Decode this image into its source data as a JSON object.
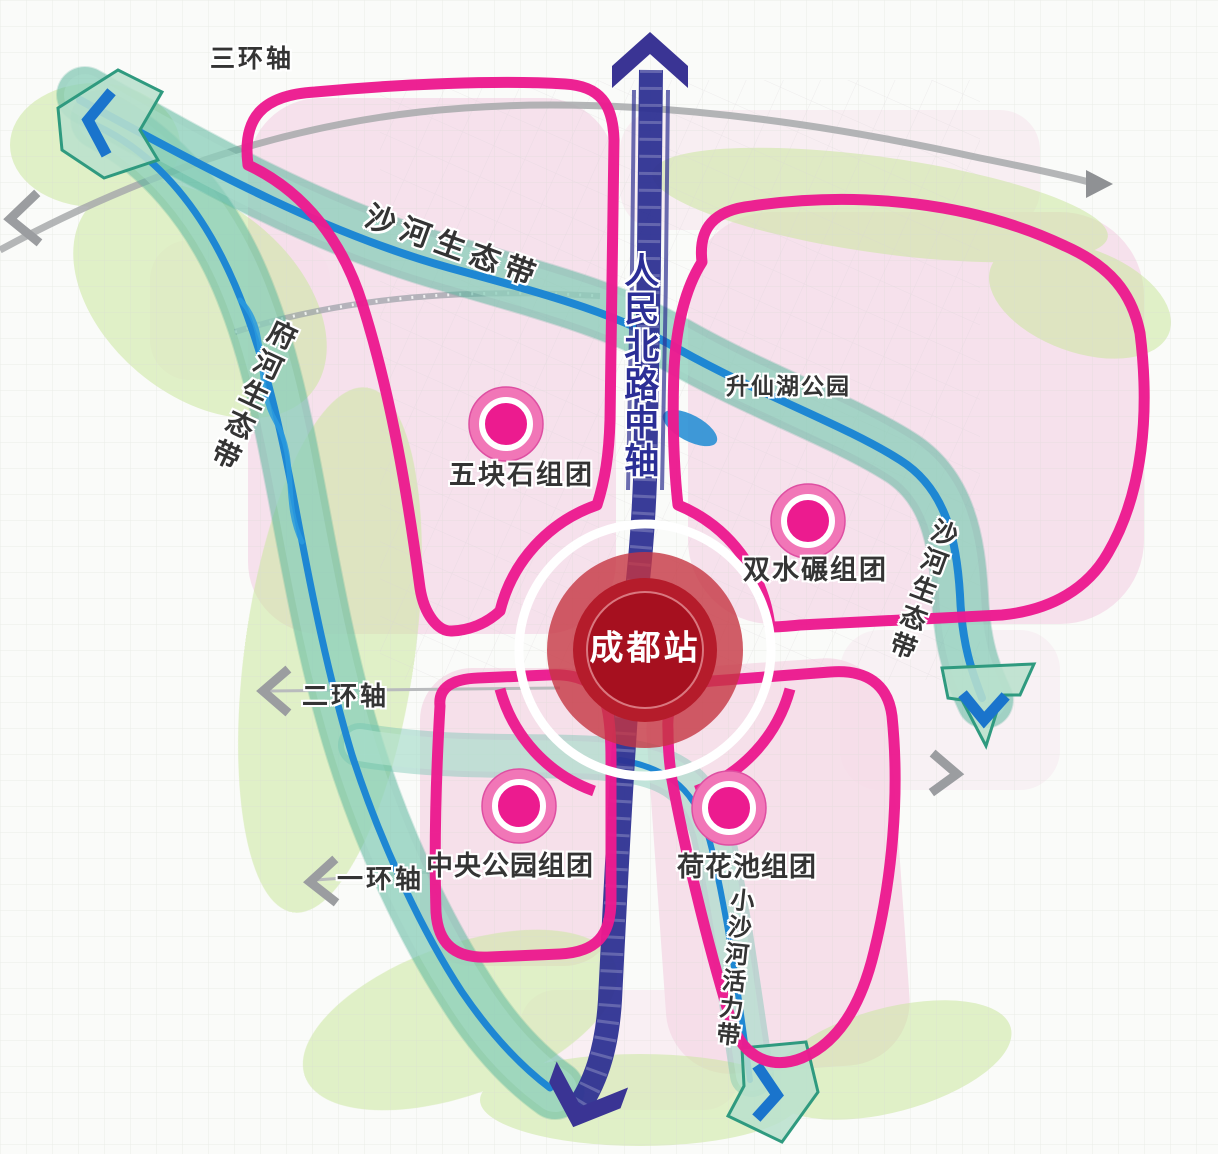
{
  "labels": {
    "ring3_axis": "三环轴",
    "ring2_axis": "二环轴",
    "ring1_axis": "一环轴",
    "central_axis": "人民北路中轴",
    "shahe_eco_top": "沙河生态带",
    "fuhe_eco": "府河生态带",
    "shahe_eco_right": "沙河生态带",
    "xiaoshahe_vitality": "小沙河活力带",
    "shengxianhu_park": "升仙湖公园",
    "wukuaishi_cluster": "五块石组团",
    "shuangshuinian_cluster": "双水碾组团",
    "central_park_cluster": "中央公园组团",
    "hehuachi_cluster": "荷花池组团",
    "chengdu_station": "成都站"
  },
  "colors": {
    "cluster_loop_magenta": "#ec1b8f",
    "marker_outer_pink": "#f176b7",
    "marker_inner_magenta": "#ec1b8f",
    "station_red_outer": "#c53642",
    "station_red_inner": "#a6101f",
    "central_axis_navy": "#2e3192",
    "central_axis_label_blue": "#2b2e96",
    "eco_band_teal": "#3a9e8a",
    "river_blue": "#1e87d3",
    "road_gray": "#a7a9ab",
    "urban_pink": "#f5dbe8",
    "park_green": "#cce9a4"
  }
}
